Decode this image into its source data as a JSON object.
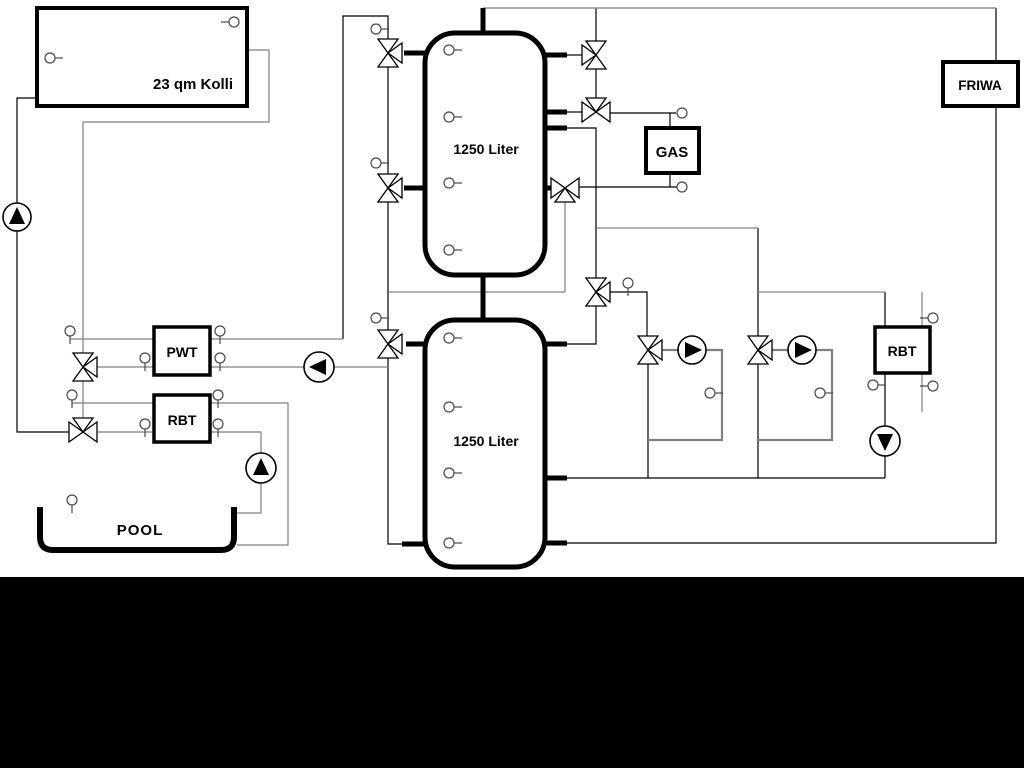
{
  "labels": {
    "collector": "23 qm Kolli",
    "tank_top": "1250 Liter",
    "tank_bottom": "1250 Liter",
    "gas": "GAS",
    "friwa": "FRIWA",
    "pwt": "PWT",
    "rbt_left": "RBT",
    "rbt_right": "RBT",
    "pool": "POOL"
  },
  "colors": {
    "background": "#ffffff",
    "letterbox": "#000000",
    "line_black": "#000000",
    "line_gray": "#808080"
  }
}
